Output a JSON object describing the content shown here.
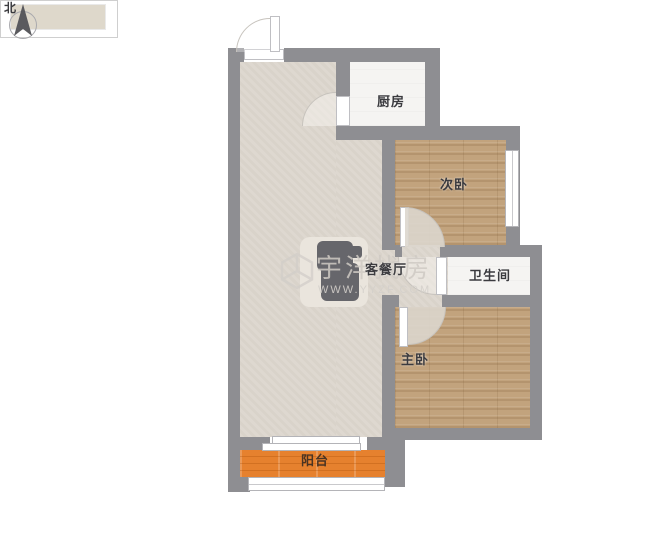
{
  "compass": {
    "label": "北"
  },
  "rooms": [
    {
      "id": "kitchen",
      "label": "厨房"
    },
    {
      "id": "secondary-bedroom",
      "label": "次卧"
    },
    {
      "id": "living-dining-room",
      "label": "客餐厅"
    },
    {
      "id": "bathroom",
      "label": "卫生间"
    },
    {
      "id": "master-bedroom",
      "label": "主卧"
    },
    {
      "id": "balcony",
      "label": "阳台"
    }
  ],
  "watermark": {
    "brand": "宇洋找房",
    "url": "WWW.YYZF.COM"
  },
  "colors": {
    "wall": "#8e8e92",
    "living_floor": "#dcd6cd",
    "wood_floor": "#c2a37d",
    "tile_floor": "#f5f4f2",
    "balcony_floor": "#e6812e"
  }
}
